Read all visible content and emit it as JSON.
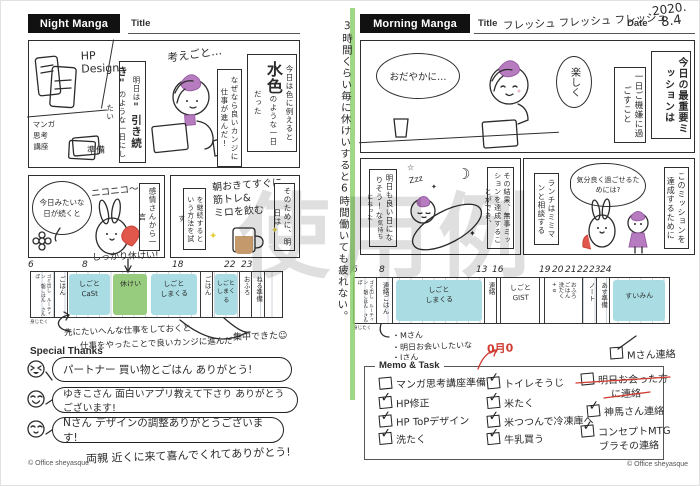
{
  "watermark": "使用例",
  "copyright": "© Office sheyasque",
  "spine": {
    "note": "3時間くらい毎に休けいすると6時間働いても疲れない。"
  },
  "left": {
    "badge": "Night Manga",
    "title_label": "Title",
    "panel1": {
      "hp_label": "HP\nDesign",
      "manga_label": "マンガ\n思考\n講座",
      "junbi_label": "準備",
      "thought": "考えごと…",
      "box_today_pre": "今日は色に例えると",
      "box_today_big": "水色",
      "box_today_post": "のような一日だった",
      "box_because": "なぜなら良いカンジに仕事が進んだ!",
      "box_tomorrow_pre": "明日は",
      "box_tomorrow_big": "\"引き続き\"",
      "box_tomorrow_post": "のような一日にしたい"
    },
    "panel2": {
      "bubble": "今日みたいな日が続くと",
      "nico": "ニコニコ〜",
      "box": "感情さんから一言"
    },
    "panel3": {
      "note": "朝おきてすぐに\n筋トレ&\nミロを飲む",
      "box_method": "を継続するという方法を試す",
      "box_next": "そのために、明日は"
    },
    "timeline": {
      "hours": [
        "6",
        "8",
        "18",
        "22",
        "23"
      ],
      "note_top": "しっかり休けい!",
      "routine": "ゴミ出し\nルーティン\n朝ごはん\nさんぽ",
      "below": "身じたく",
      "seg_gohan1": "ごはん",
      "seg_work1": "しごと\nCaSt",
      "seg_rest": "休けい",
      "seg_work2": "しごと\nしまくる",
      "seg_gohan2": "ごはん",
      "seg_work3": "しごと\nしまくる",
      "seg_ofuro": "おふろ",
      "seg_neru": "ねる準備",
      "note1": "先にたいへんな仕事をしておくと",
      "note2": "仕事をやったことで良いカンジに進んだ",
      "note3": "集中できた☺"
    },
    "thanks": {
      "label": "Special Thanks",
      "items": [
        {
          "text": "パートナー 買い物とごはん ありがとう!"
        },
        {
          "text": "ゆきこさん 面白いアプリ教えて下さり ありがとうございます!"
        },
        {
          "text": "Nさん デザインの調整ありがとうございます!"
        }
      ],
      "extra": "両親 近くに来て喜んでくれてありがとう!"
    }
  },
  "right": {
    "badge": "Morning Manga",
    "title_label": "Title",
    "title_value": "フレッシュ フレッシュ フレッシュ",
    "date_label": "Date",
    "date_value1": "2020.",
    "date_value2": "8.4",
    "panel1": {
      "bubble1": "おだやかに…",
      "bubble2": "楽しく",
      "box_goal": "一日ご機嫌に過ごすこと",
      "box_mission": "今日の最重要ミッションは"
    },
    "panel2": {
      "zzz": "Zzz",
      "box_result": "その結果、無事ミッションを達成することができ、",
      "box_feel_big": "明日も良い日になりそう!な",
      "box_feel_small": "気持ちになった"
    },
    "panel3": {
      "thought": "気分良く過ごせるためには?",
      "box_lunch": "ランチはミミマンと相談する",
      "box_for": "このミッションを達成するために"
    },
    "timeline": {
      "hours": [
        "6",
        "8",
        "13",
        "16",
        "19",
        "20",
        "21",
        "22",
        "23",
        "24"
      ],
      "routine": "ゴミ出し\nルーティン\n朝ごはん\nさんぽ",
      "below": "身じたく",
      "seg_renraku1": "連絡ごはん",
      "seg_work1": "しごと\nしまくる",
      "seg_renraku2": "連絡",
      "seg_work2": "しごと\nGIST",
      "seg_home": "おふろ\nごはん\n洗たく\n+α",
      "seg_note": "ノート",
      "seg_prep": "あす準備",
      "seg_sleep": "すいみん",
      "note1": "・Mさん",
      "note2": "・明日お会いしたいな",
      "note3": "・Jさん"
    },
    "red_note": "0月0",
    "float_task": {
      "text": "Mさん連絡"
    },
    "memo": {
      "label": "Memo & Task",
      "col1": [
        {
          "mark": "",
          "text": "マンガ思考講座準備"
        },
        {
          "mark": "✓",
          "text": "HP修正"
        },
        {
          "mark": "✓",
          "text": "HP ToPデザイン"
        },
        {
          "mark": "✓",
          "text": "洗たく"
        }
      ],
      "col2": [
        {
          "mark": "✓",
          "text": "トイレそうじ"
        },
        {
          "mark": "✓",
          "text": "米たく"
        },
        {
          "mark": "✓",
          "text": "米つつんで冷凍庫へ"
        },
        {
          "mark": "✓",
          "text": "牛乳買う"
        }
      ],
      "col3": [
        {
          "mark": "",
          "text": "明日お会った方",
          "text2": "に連絡"
        },
        {
          "mark": "✓",
          "text": "神馬さん連絡"
        },
        {
          "mark": "✓",
          "text": "コンセプトMTG",
          "text2": "ブラその連絡"
        }
      ]
    }
  },
  "colors": {
    "highlight_blue": "#a9dce3",
    "highlight_green": "#97cb7d",
    "accent_purple": "#b77cc0",
    "ink": "#2b2b2b",
    "red_pen": "#cf3b30",
    "spine_green": "#8ed06e",
    "watermark_gray": "#cfcfcf"
  }
}
